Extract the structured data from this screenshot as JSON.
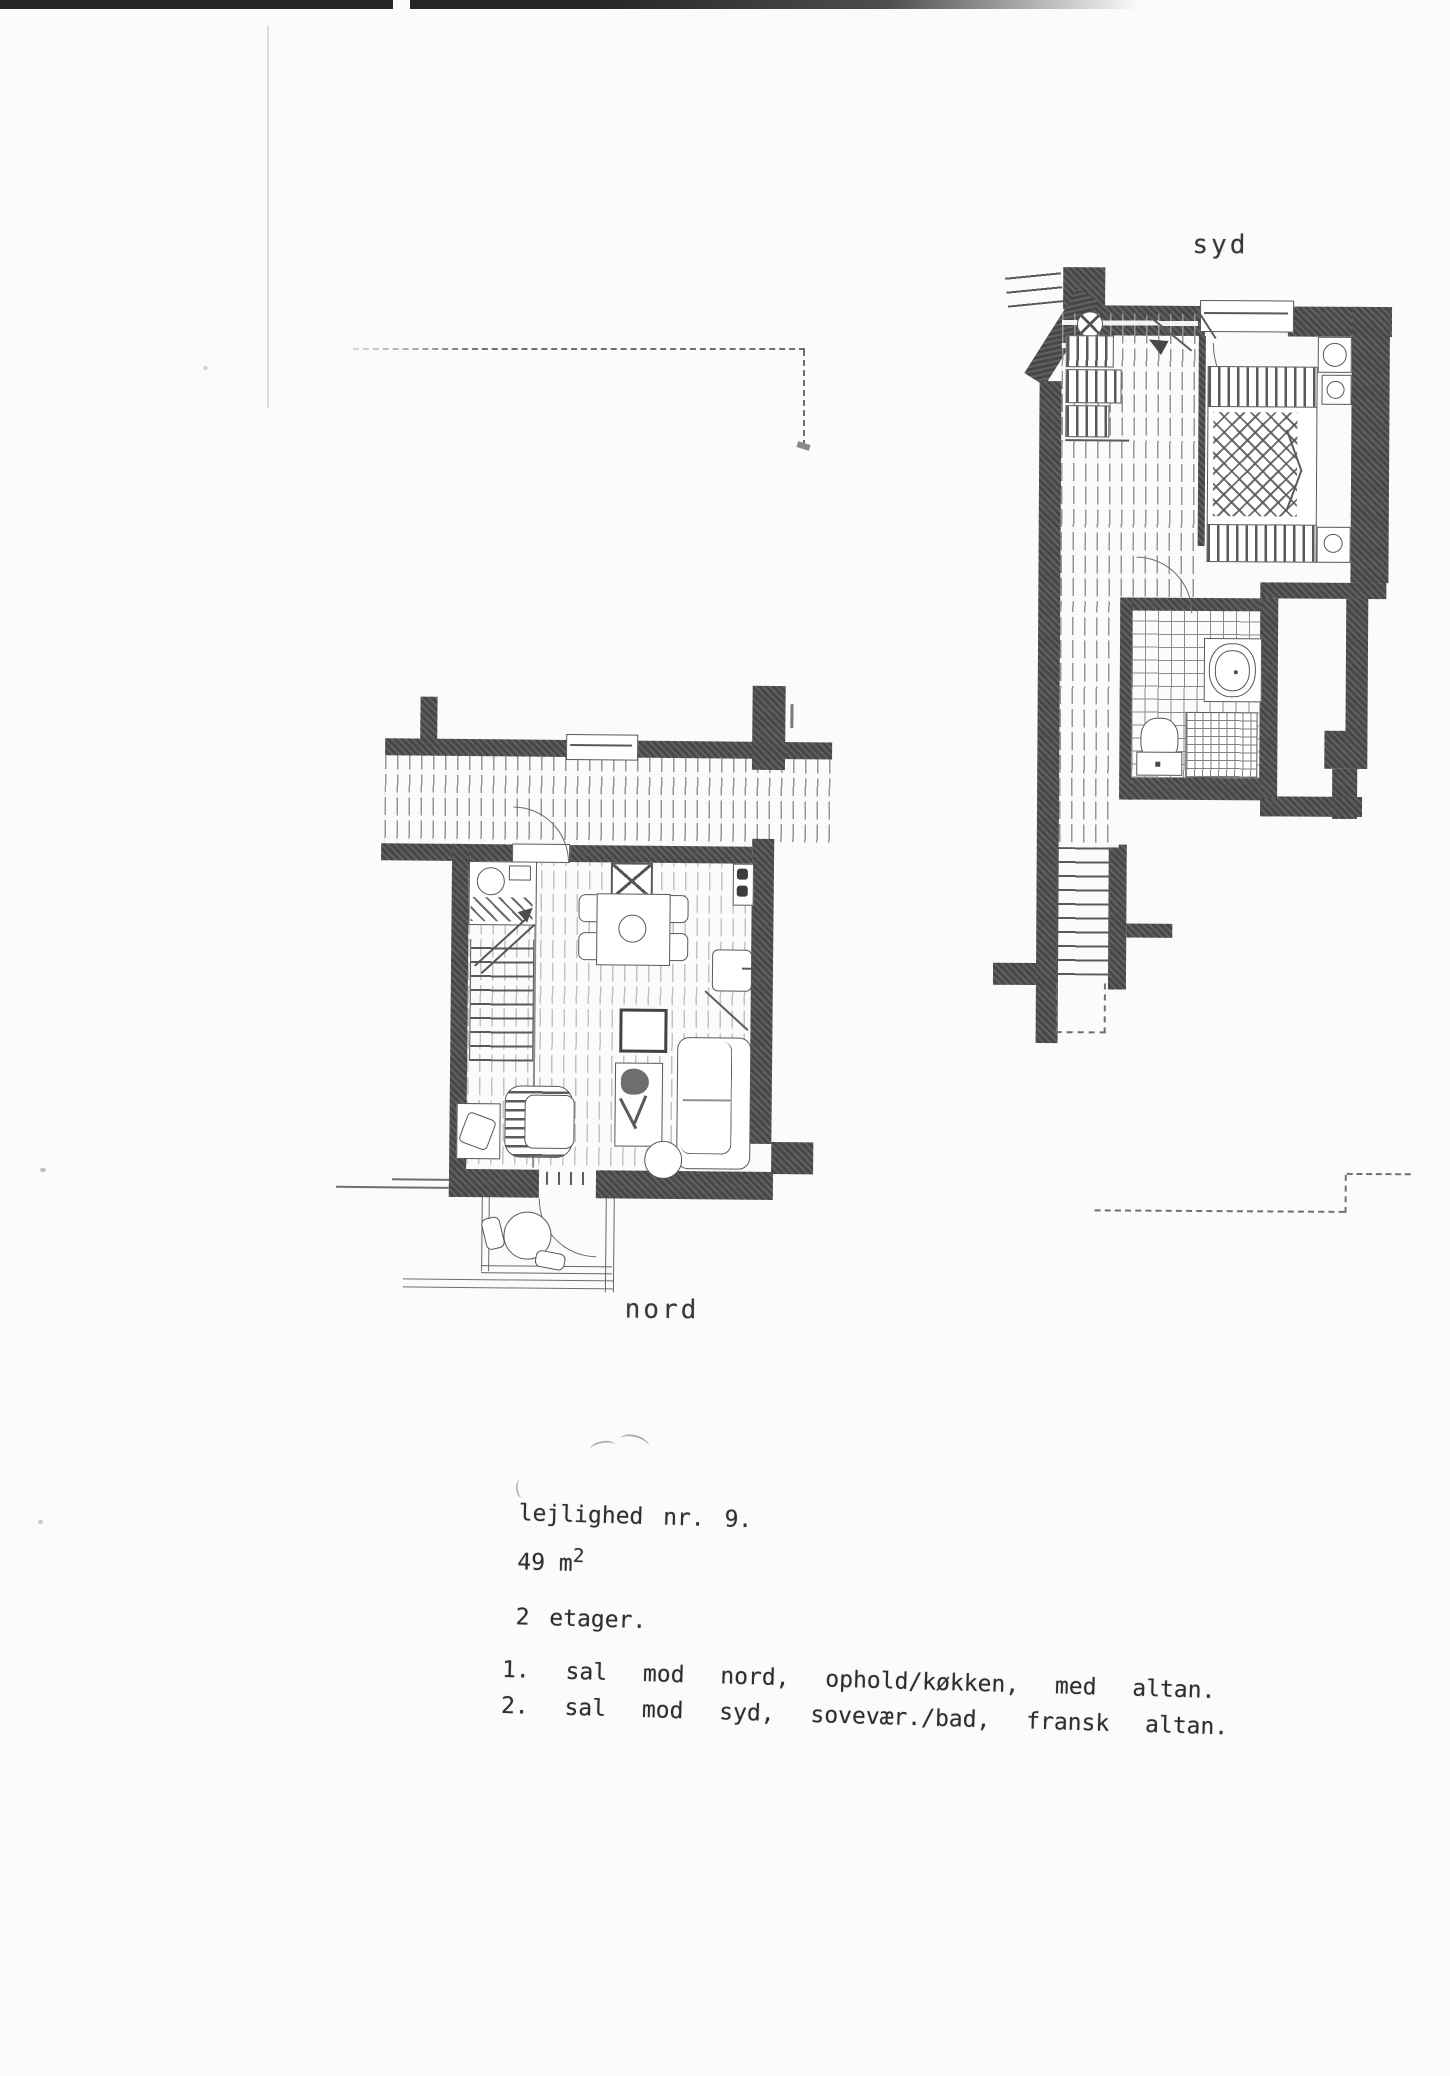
{
  "page": {
    "label_south": "syd",
    "label_north": "nord",
    "paper_color": "#fbfbfa",
    "ink_color": "#3e3e3e",
    "wall_color": "#4b4b4b"
  },
  "info": {
    "line1": "lejlighed nr. 9.",
    "line2_value": "49 m",
    "line2_sup": "2",
    "line3": "2 etager.",
    "line4": "1. sal mod nord, ophold/køkken, med altan.",
    "line5": "2. sal mod syd, sovevær./bad, fransk altan."
  }
}
